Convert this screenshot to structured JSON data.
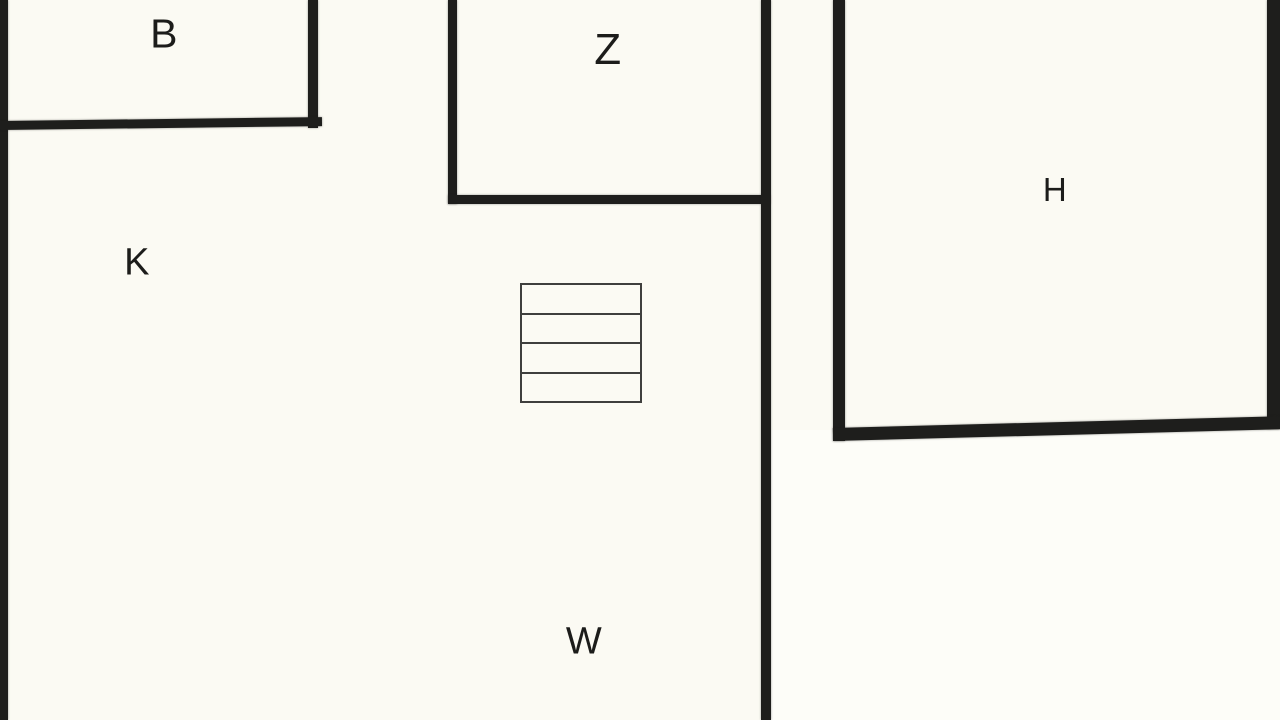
{
  "plan": {
    "kind": "floor-plan",
    "rooms": [
      {
        "id": "b",
        "label": "B"
      },
      {
        "id": "z",
        "label": "Z"
      },
      {
        "id": "k",
        "label": "K"
      },
      {
        "id": "h",
        "label": "H"
      },
      {
        "id": "w",
        "label": "W"
      }
    ],
    "stairs": {
      "steps": 4
    }
  },
  "colors": {
    "background": "#fbfaf3",
    "exterior": "#fdfdf8",
    "wall": "#1e1e1c",
    "stairs_stroke": "#3f3f3d",
    "label": "#1c1c1a"
  }
}
